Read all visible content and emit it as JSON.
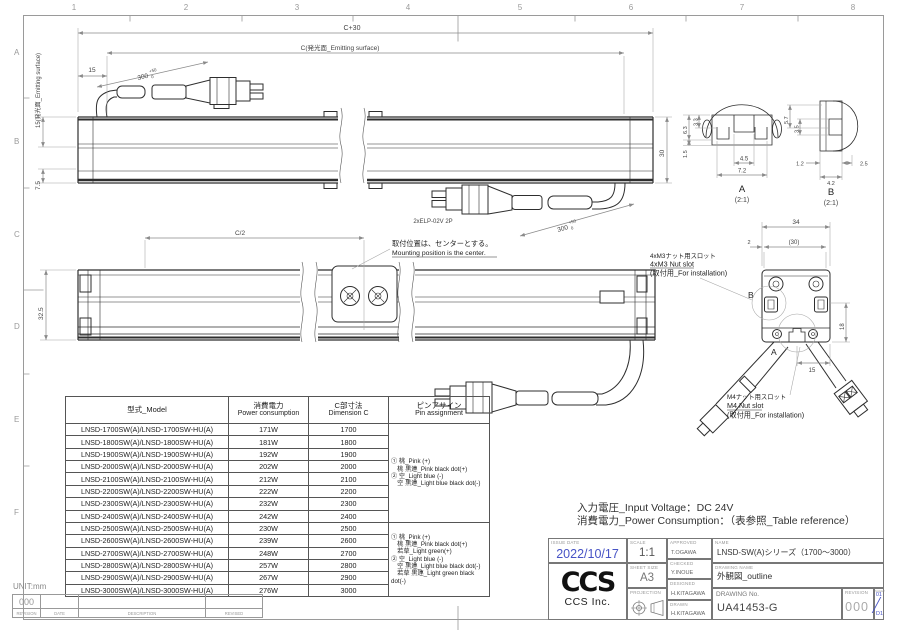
{
  "frame": {
    "cols": [
      "1",
      "2",
      "3",
      "4",
      "5",
      "6",
      "7",
      "8"
    ],
    "rows": [
      "A",
      "B",
      "C",
      "D",
      "E",
      "F"
    ]
  },
  "drawing": {
    "view_top": {
      "dim_c30": "C+30",
      "dim_c": "C(発光面_Emitting surface)",
      "dim_15": "15",
      "dim_300": "300",
      "tol_plus": "+50",
      "tol_minus": "0",
      "dim_left_emitting": "15(発光面_Emitting surface)",
      "dim_7_5": "7.5",
      "dim_30": "30",
      "connector_label": "2xELP-02V 2P"
    },
    "view_bottom": {
      "dim_c2": "C/2",
      "dim_32_5": "32.5",
      "note_jp": "取付位置は、センターとする。",
      "note_en": "Mounting position is the center."
    },
    "section_a": {
      "name": "A",
      "scale": "(2:1)",
      "d63": "6.3",
      "d33": "3.3",
      "d15": "1.5",
      "d45": "4.5",
      "d72": "7.2"
    },
    "section_b": {
      "name": "B",
      "scale": "(2:1)",
      "d57": "5.7",
      "d35": "3.5",
      "d12": "1.2",
      "d25": "2.5",
      "d42": "4.2"
    },
    "end_view": {
      "dim_34": "34",
      "dim_2": "2",
      "dim_30p": "(30)",
      "dim_18": "18",
      "dim_15": "15",
      "marker_a": "A",
      "marker_b": "B",
      "m3_jp": "4xM3ナット用スロット",
      "m3_en": "4xM3 Nut slot",
      "m3_note": "(取付用_For installation)",
      "m4_jp": "M4ナット用スロット",
      "m4_en": "M4 Nut slot",
      "m4_note": "(取付用_For installation)"
    }
  },
  "table": {
    "headers": {
      "model": "型式_Model",
      "power_jp": "消費電力",
      "power_en": "Power consumption",
      "c_jp": "C部寸法",
      "c_en": "Dimension C",
      "pin_jp": "ピンアサイン",
      "pin_en": "Pin assignment"
    },
    "rows": [
      {
        "model": "LNSD-1700SW(A)/LNSD-1700SW-HU(A)",
        "power": "171W",
        "c": "1700"
      },
      {
        "model": "LNSD-1800SW(A)/LNSD-1800SW-HU(A)",
        "power": "181W",
        "c": "1800"
      },
      {
        "model": "LNSD-1900SW(A)/LNSD-1900SW-HU(A)",
        "power": "192W",
        "c": "1900"
      },
      {
        "model": "LNSD-2000SW(A)/LNSD-2000SW-HU(A)",
        "power": "202W",
        "c": "2000"
      },
      {
        "model": "LNSD-2100SW(A)/LNSD-2100SW-HU(A)",
        "power": "212W",
        "c": "2100"
      },
      {
        "model": "LNSD-2200SW(A)/LNSD-2200SW-HU(A)",
        "power": "222W",
        "c": "2200"
      },
      {
        "model": "LNSD-2300SW(A)/LNSD-2300SW-HU(A)",
        "power": "232W",
        "c": "2300"
      },
      {
        "model": "LNSD-2400SW(A)/LNSD-2400SW-HU(A)",
        "power": "242W",
        "c": "2400"
      },
      {
        "model": "LNSD-2500SW(A)/LNSD-2500SW-HU(A)",
        "power": "230W",
        "c": "2500"
      },
      {
        "model": "LNSD-2600SW(A)/LNSD-2600SW-HU(A)",
        "power": "239W",
        "c": "2600"
      },
      {
        "model": "LNSD-2700SW(A)/LNSD-2700SW-HU(A)",
        "power": "248W",
        "c": "2700"
      },
      {
        "model": "LNSD-2800SW(A)/LNSD-2800SW-HU(A)",
        "power": "257W",
        "c": "2800"
      },
      {
        "model": "LNSD-2900SW(A)/LNSD-2900SW-HU(A)",
        "power": "267W",
        "c": "2900"
      },
      {
        "model": "LNSD-3000SW(A)/LNSD-3000SW-HU(A)",
        "power": "276W",
        "c": "3000"
      }
    ],
    "pin_split_after_row": 8,
    "pin_group_1": [
      "① 桃_Pink (+)",
      "　桃 黒連_Pink black dot(+)",
      "② 空_Light blue (-)",
      "　空 黒連_Light blue black dot(-)"
    ],
    "pin_group_2": [
      "① 桃_Pink (+)",
      "　桃 黒連_Pink black dot(+)",
      "　若草_Light green(+)",
      "② 空_Light blue (-)",
      "　空 黒連_Light blue black dot(-)",
      "　若草 黒連_Light green black dot(-)"
    ]
  },
  "notes": {
    "voltage": "入力電圧_Input Voltage：DC 24V",
    "power": "消費電力_Power Consumption：（表参照_Table reference）"
  },
  "title_block": {
    "issue_date_label": "ISSUE DATE",
    "issue_date": "2022/10/17",
    "scale_label": "SCALE",
    "scale": "1:1",
    "sheet_size_label": "SHEET SIZE",
    "sheet_size": "A3",
    "projection_label": "PROJECTION",
    "approved_label": "APPROVED",
    "approved": "T.OGAWA",
    "checked_label": "CHECKED",
    "checked": "Y.INOUE",
    "designed_label": "DESIGNED",
    "designed": "H.KITAGAWA",
    "drawn_label": "DRAWN",
    "drawn": "H.KITAGAWA",
    "name_label": "NAME",
    "name": "LNSD-SW(A)シリーズ（1700～3000）",
    "drawing_name_label": "DRAWING NAME",
    "drawing_name": "外観図_outline",
    "drawing_no_label": "DRAWING No.",
    "drawing_no": "UA41453-G",
    "revision_label": "REVISION",
    "revision": "000",
    "sheet_label": "SHEET",
    "sheet_top": "01",
    "sheet_bottom": "D1",
    "logo_text": "CCS",
    "logo_sub": "CCS Inc."
  },
  "revision_strip": {
    "unit": "UNIT:mm",
    "value": "000",
    "headers": [
      "REVISION",
      "DATE",
      "DESCRIPTION",
      "REVISED"
    ]
  },
  "colors": {
    "accent_blue": "#4753c5",
    "line": "#2e2e2e",
    "dim": "#8a8a8a",
    "frame": "#9a9a9a"
  }
}
